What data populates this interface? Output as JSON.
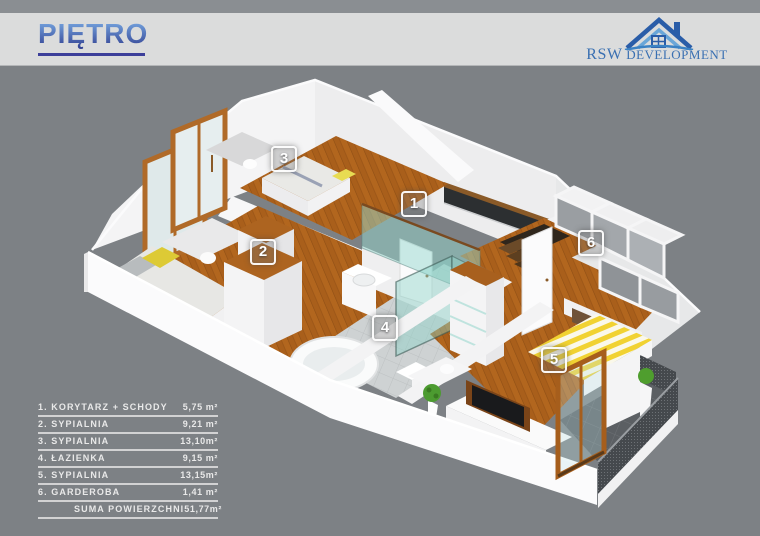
{
  "header": {
    "title": "PIĘTRO"
  },
  "logo": {
    "name_primary": "RSW",
    "name_secondary": "DEVELOPMENT"
  },
  "plan": {
    "badges": [
      "1",
      "2",
      "3",
      "4",
      "5",
      "6"
    ]
  },
  "legend": {
    "items": [
      {
        "label": "1. KORYTARZ + SCHODY",
        "value": "5,75 m²"
      },
      {
        "label": "2. SYPIALNIA",
        "value": "9,21 m²"
      },
      {
        "label": "3. SYPIALNIA",
        "value": "13,10m²"
      },
      {
        "label": "4. ŁAZIENKA",
        "value": "9,15 m²"
      },
      {
        "label": "5. SYPIALNIA",
        "value": "13,15m²"
      },
      {
        "label": "6. GARDEROBA",
        "value": "1,41 m²"
      },
      {
        "label": "SUMA POWIERZCHNI",
        "value": "51,77m²"
      }
    ]
  },
  "colors": {
    "background": "#7d8185",
    "header_band": "#dbdcdc",
    "title_blue": "#3b4a9b",
    "logo_blue": "#3a70b2",
    "wood_floor": "#b2661e",
    "glass_teal": "#9fd8d2",
    "bed_yellow": "#f1d232",
    "wall_white": "#f4f4f5"
  }
}
